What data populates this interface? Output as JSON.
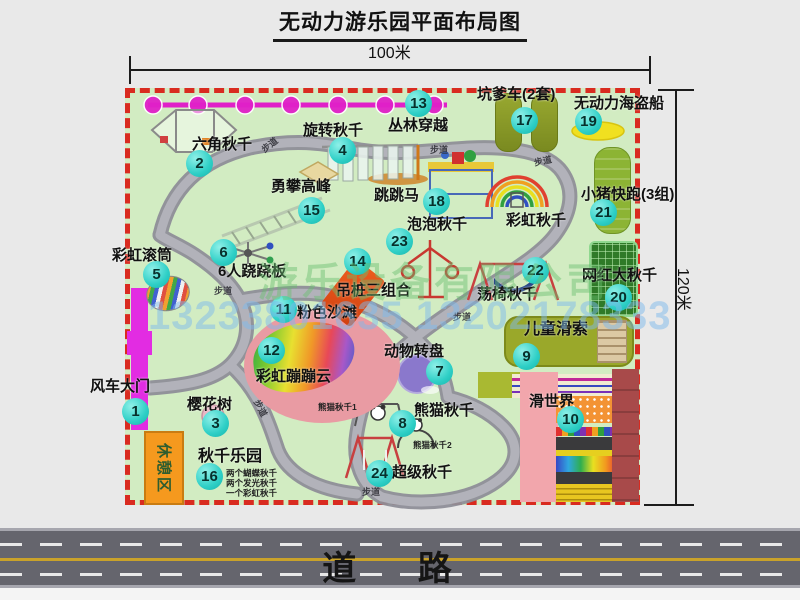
{
  "title": "无动力游乐园平面布局图",
  "dimensions": {
    "width": "100米",
    "height": "120米"
  },
  "road": {
    "label": "道 路"
  },
  "watermark": {
    "company": "游乐设备有限公司",
    "phone": "13233801635 13202178333"
  },
  "trail_label": "步道",
  "pois": {
    "p1": {
      "num": "1",
      "label": "风车大门"
    },
    "p2": {
      "num": "2",
      "label": "六角秋千"
    },
    "p3": {
      "num": "3",
      "label": "樱花树"
    },
    "p4": {
      "num": "4",
      "label": "旋转秋千"
    },
    "p5": {
      "num": "5",
      "label": "彩虹滚筒"
    },
    "p6": {
      "num": "6",
      "label": "6人跷跷板"
    },
    "p7": {
      "num": "7",
      "label": "动物转盘"
    },
    "p8": {
      "num": "8",
      "label": "熊猫秋千",
      "sub1": "熊猫秋千1",
      "sub2": "熊猫秋千2"
    },
    "p9": {
      "num": "9",
      "label": "儿童滑索"
    },
    "p10": {
      "num": "10",
      "label": "滑世界"
    },
    "p11": {
      "num": "11",
      "label": "粉色沙滩"
    },
    "p12": {
      "num": "12",
      "label": "彩虹蹦蹦云"
    },
    "p13": {
      "num": "13",
      "label": "丛林穿越"
    },
    "p14": {
      "num": "14",
      "label": "吊桩三组合"
    },
    "p15": {
      "num": "15",
      "label": "勇攀高峰"
    },
    "p16": {
      "num": "16",
      "label": "秋千乐园",
      "notes": [
        "两个蝴蝶秋千",
        "两个发光秋千",
        "一个彩虹秋千"
      ]
    },
    "p17": {
      "num": "17",
      "label": "坑爹车(2套)"
    },
    "p18": {
      "num": "18",
      "label": "跳跳马"
    },
    "p19": {
      "num": "19",
      "label": "无动力海盗船"
    },
    "p20": {
      "num": "20",
      "label": "网红大秋千"
    },
    "p21": {
      "num": "21",
      "label": "小猪快跑(3组)"
    },
    "p22": {
      "num": "22",
      "label": "荡椅秋千"
    },
    "p23": {
      "num": "23",
      "label": "泡泡秋千"
    },
    "p24": {
      "num": "24",
      "label": "超级秋千"
    },
    "rainbow_swing": {
      "label": "彩虹秋千"
    },
    "rest_area": {
      "label": "休憩区"
    }
  },
  "colors": {
    "boundary": "#d92b20",
    "ground": "#d2ecc2",
    "badge": "#2ecfc6",
    "zipline": "#e020c8",
    "road": "#65656d",
    "gate": "#e22ce2"
  }
}
